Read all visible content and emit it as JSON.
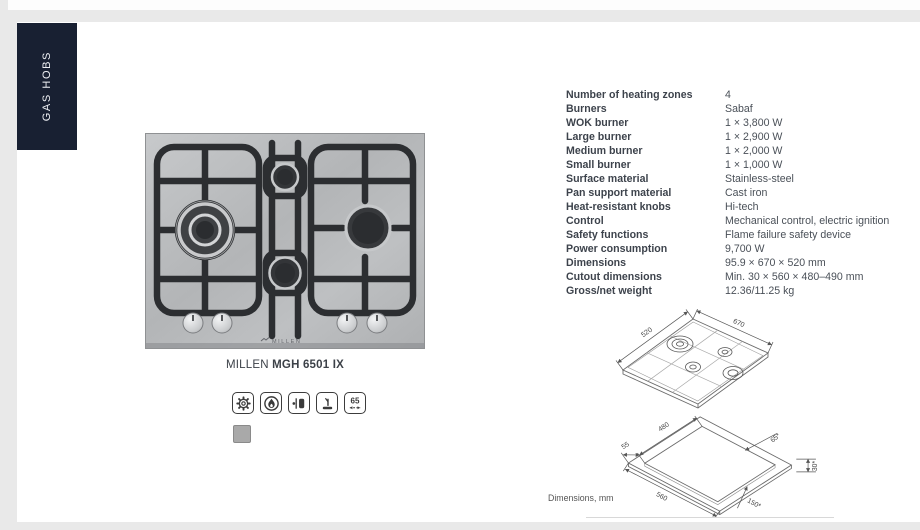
{
  "sidebar": {
    "tab_label": "GAS HOBS"
  },
  "product": {
    "brand": "MILLEN",
    "model": "MGH 6501 IX",
    "hob_logo": "MILLEN",
    "swatch_color": "#a9a9a9",
    "feature_badges": {
      "width_label": "65"
    }
  },
  "specs": {
    "rows": [
      {
        "label": "Number of heating zones",
        "value": "4"
      },
      {
        "label": "Burners",
        "value": "Sabaf"
      },
      {
        "label": "WOK burner",
        "value": "1 × 3,800 W"
      },
      {
        "label": "Large burner",
        "value": "1 × 2,900 W"
      },
      {
        "label": "Medium burner",
        "value": "1 × 2,000 W"
      },
      {
        "label": "Small burner",
        "value": "1 × 1,000 W"
      },
      {
        "label": "Surface material",
        "value": "Stainless-steel"
      },
      {
        "label": "Pan support material",
        "value": "Cast iron"
      },
      {
        "label": "Heat-resistant knobs",
        "value": "Hi-tech"
      },
      {
        "label": "Control",
        "value": "Mechanical control, electric ignition"
      },
      {
        "label": "Safety functions",
        "value": "Flame failure safety device"
      },
      {
        "label": "Power consumption",
        "value": "9,700 W"
      },
      {
        "label": "Dimensions",
        "value": "95.9 × 670 × 520 mm"
      },
      {
        "label": "Cutout dimensions",
        "value": "Min. 30 × 560 × 480–490 mm"
      },
      {
        "label": "Gross/net weight",
        "value": "12.36/11.25 kg"
      }
    ]
  },
  "drawings": {
    "caption": "Dimensions, mm",
    "top_view": {
      "labels": [
        "520",
        "670"
      ]
    },
    "cutout_view": {
      "labels": [
        "55",
        "480",
        "65*",
        "30*",
        "560",
        "150*"
      ]
    }
  },
  "colors": {
    "tab_bg": "#182032",
    "page_bg": "#e9e9e9",
    "text": "#3d434c"
  }
}
